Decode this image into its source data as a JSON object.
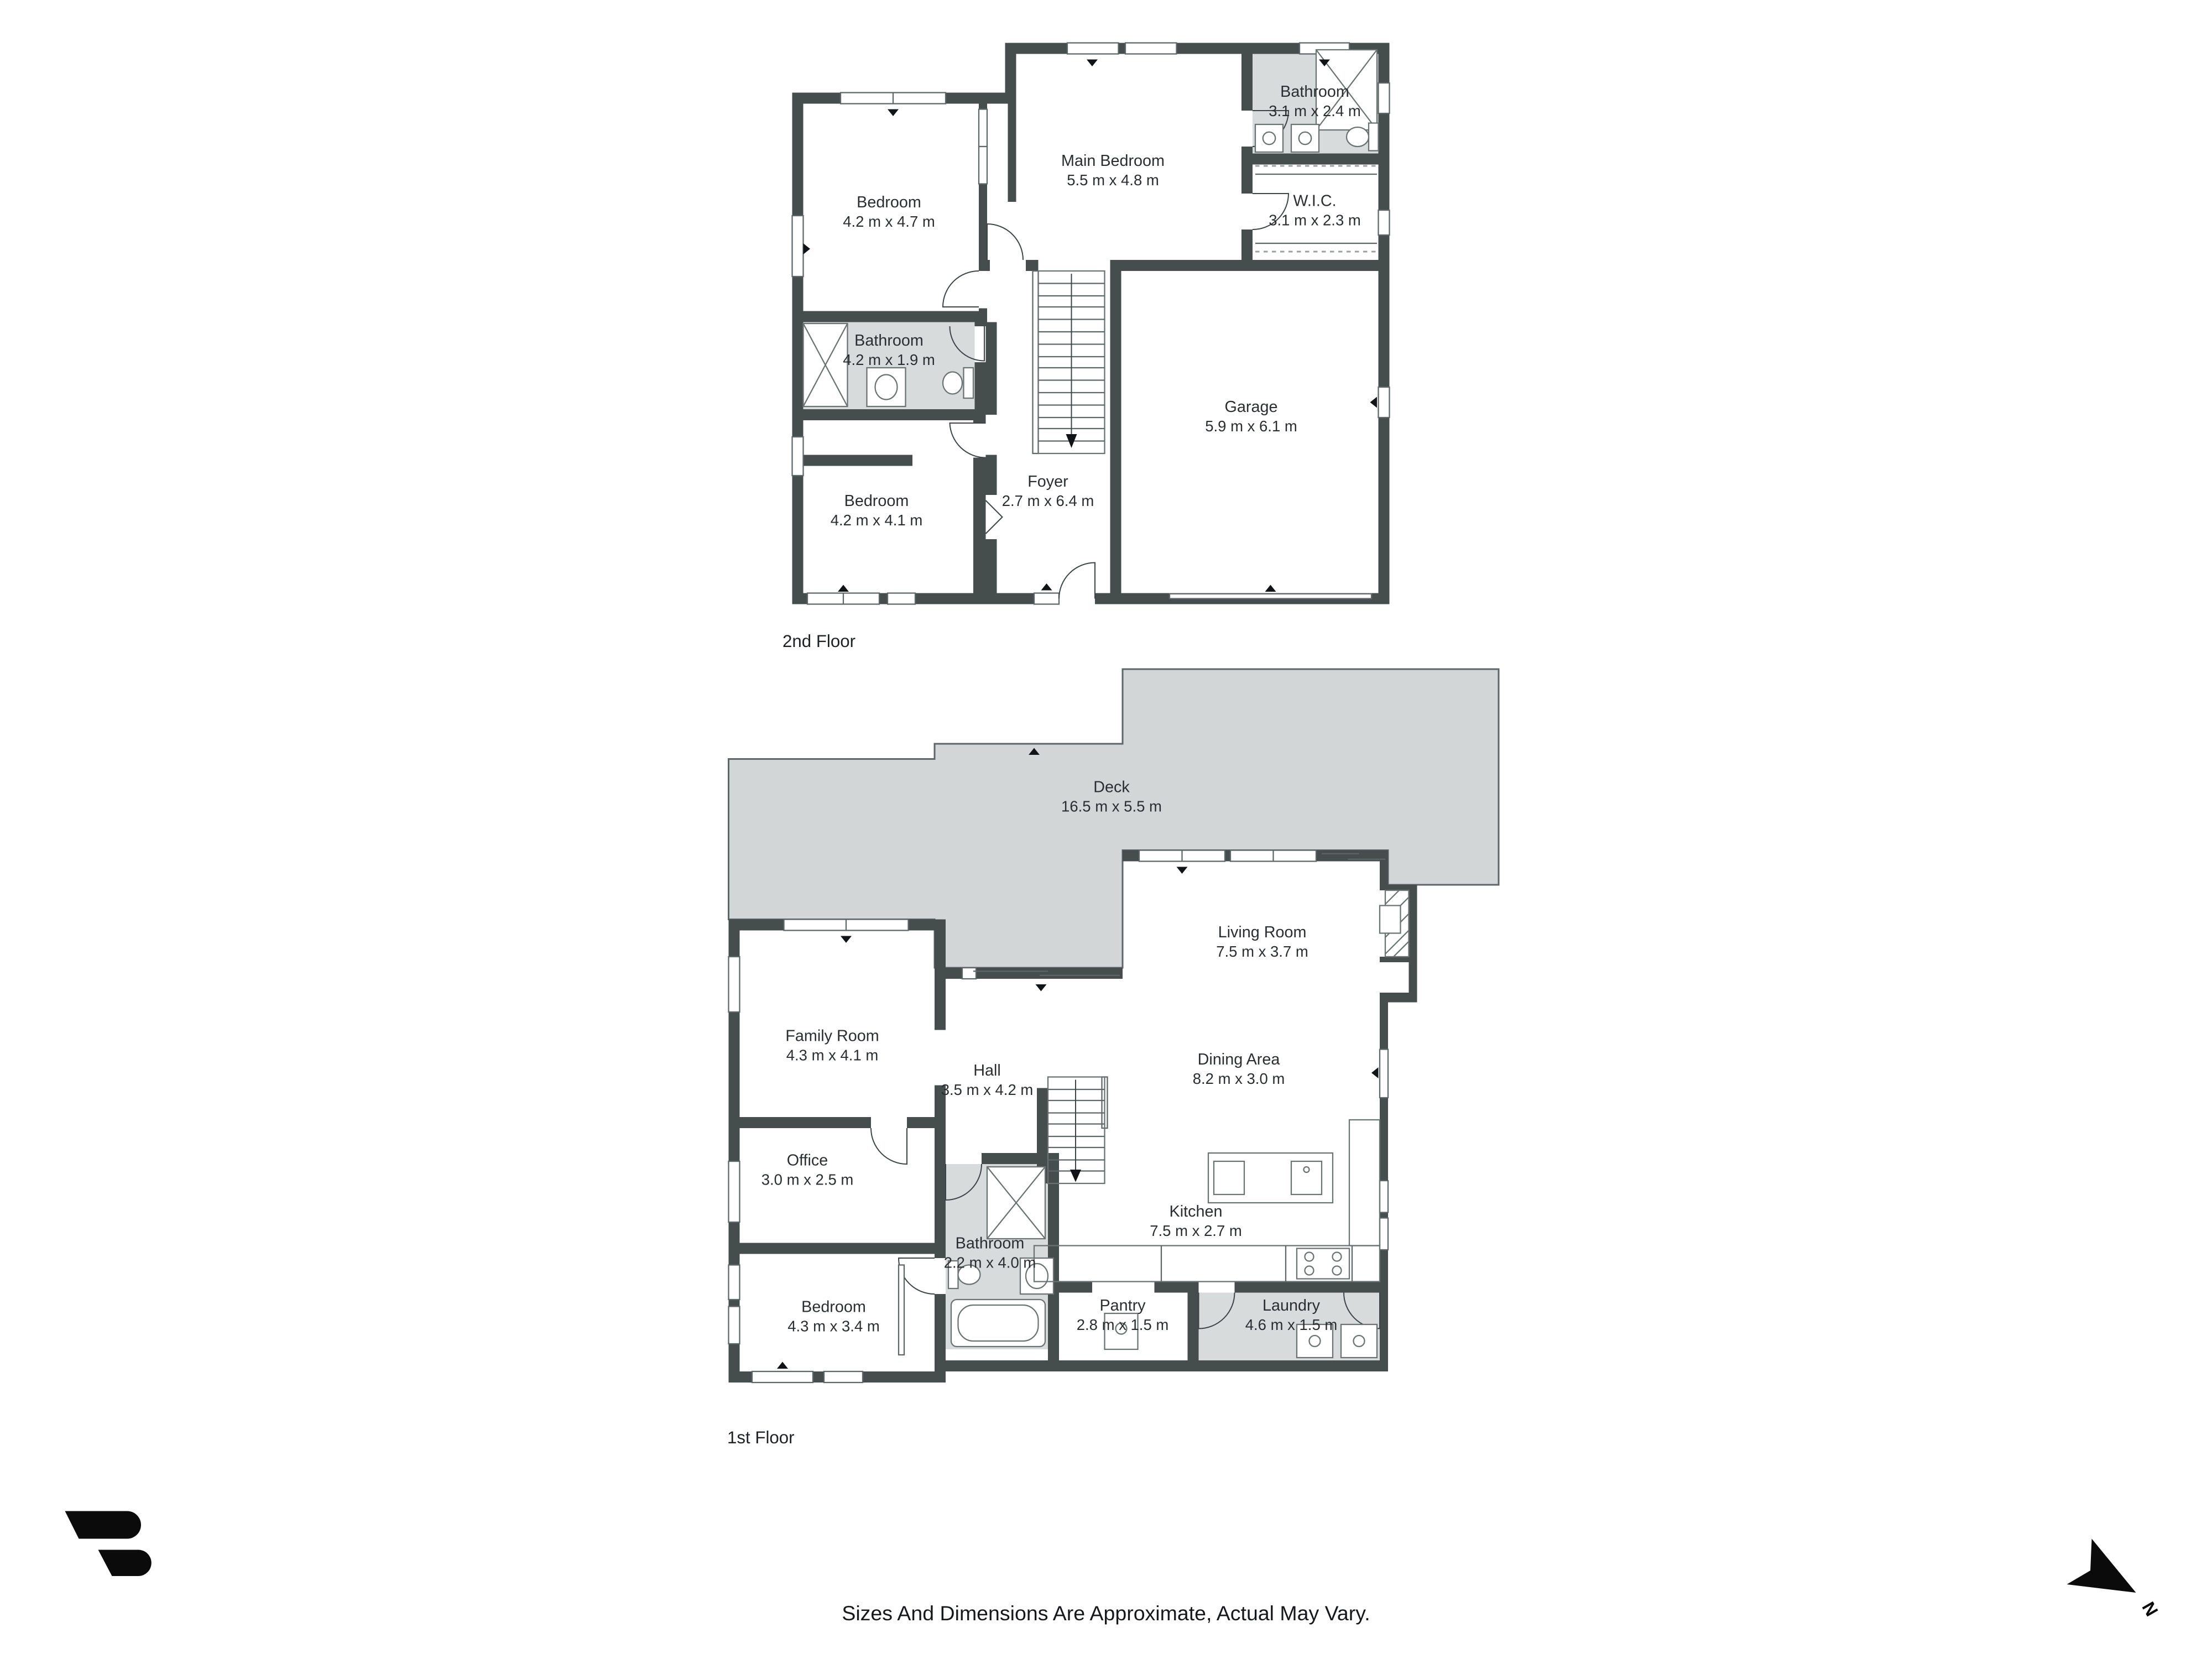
{
  "document": {
    "type": "real-estate floor plan",
    "background": "#ffffff"
  },
  "floors": [
    {
      "label": "2nd Floor",
      "rooms": [
        {
          "name": "Bedroom",
          "dims": "4.2 m x 4.7 m"
        },
        {
          "name": "Main Bedroom",
          "dims": "5.5 m x 4.8 m"
        },
        {
          "name": "Bathroom",
          "dims": "3.1 m x 2.4 m"
        },
        {
          "name": "W.I.C.",
          "dims": "3.1 m x 2.3 m"
        },
        {
          "name": "Bathroom",
          "dims": "4.2 m x 1.9 m"
        },
        {
          "name": "Garage",
          "dims": "5.9 m x 6.1 m"
        },
        {
          "name": "Bedroom",
          "dims": "4.2 m x 4.1 m"
        },
        {
          "name": "Foyer",
          "dims": "2.7 m x 6.4 m"
        }
      ]
    },
    {
      "label": "1st Floor",
      "rooms": [
        {
          "name": "Deck",
          "dims": "16.5 m x 5.5 m"
        },
        {
          "name": "Living Room",
          "dims": "7.5 m x 3.7 m"
        },
        {
          "name": "Family Room",
          "dims": "4.3 m x 4.1 m"
        },
        {
          "name": "Hall",
          "dims": "3.5 m x 4.2 m"
        },
        {
          "name": "Dining Area",
          "dims": "8.2 m x 3.0 m"
        },
        {
          "name": "Office",
          "dims": "3.0 m x 2.5 m"
        },
        {
          "name": "Bathroom",
          "dims": "2.2 m x 4.0 m"
        },
        {
          "name": "Kitchen",
          "dims": "7.5 m x 2.7 m"
        },
        {
          "name": "Bedroom",
          "dims": "4.3 m x 3.4 m"
        },
        {
          "name": "Pantry",
          "dims": "2.8 m x 1.5 m"
        },
        {
          "name": "Laundry",
          "dims": "4.6 m x 1.5 m"
        }
      ]
    }
  ],
  "compass": {
    "label": "N"
  },
  "footer": {
    "disclaimer": "Sizes And Dimensions Are Approximate, Actual May Vary."
  },
  "colors": {
    "wall": "#454E4D",
    "wet_room_fill": "#D8DBDB",
    "deck_fill": "#D3D6D6",
    "line": "#5E6667",
    "text": "#2A2E31",
    "logo": "#0B0B0B"
  }
}
